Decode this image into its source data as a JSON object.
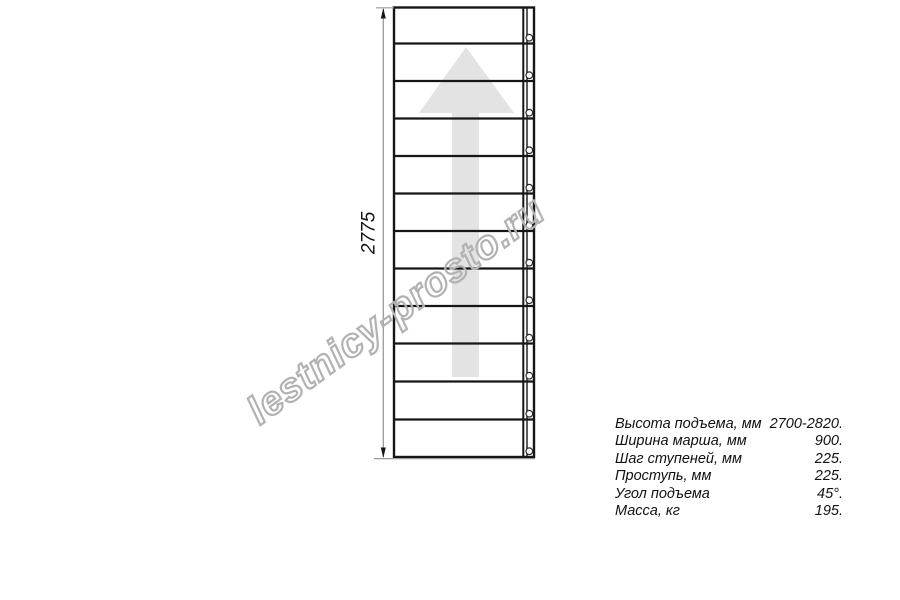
{
  "watermark": {
    "text": "lestnicy-prosto.ru"
  },
  "diagram": {
    "dimension_label": "2775",
    "steps_count": 12,
    "view": "staircase straight flight top view with up direction arrow"
  },
  "specs": {
    "rows": [
      {
        "label": "Высота подъема, мм",
        "value": "2700-2820."
      },
      {
        "label": "Ширина марша, мм",
        "value": "900."
      },
      {
        "label": "Шаг ступеней, мм",
        "value": "225."
      },
      {
        "label": "Проступь, мм",
        "value": "225."
      },
      {
        "label": "Угол подъема",
        "value": "45°."
      },
      {
        "label": "Масса, кг",
        "value": "195."
      }
    ]
  },
  "colors": {
    "line": "#161616",
    "dimension_gray": "#9a9a9a",
    "arrow_fill": "#e3e3e3",
    "watermark_stroke": "#b2b2b2",
    "background": "#ffffff"
  }
}
